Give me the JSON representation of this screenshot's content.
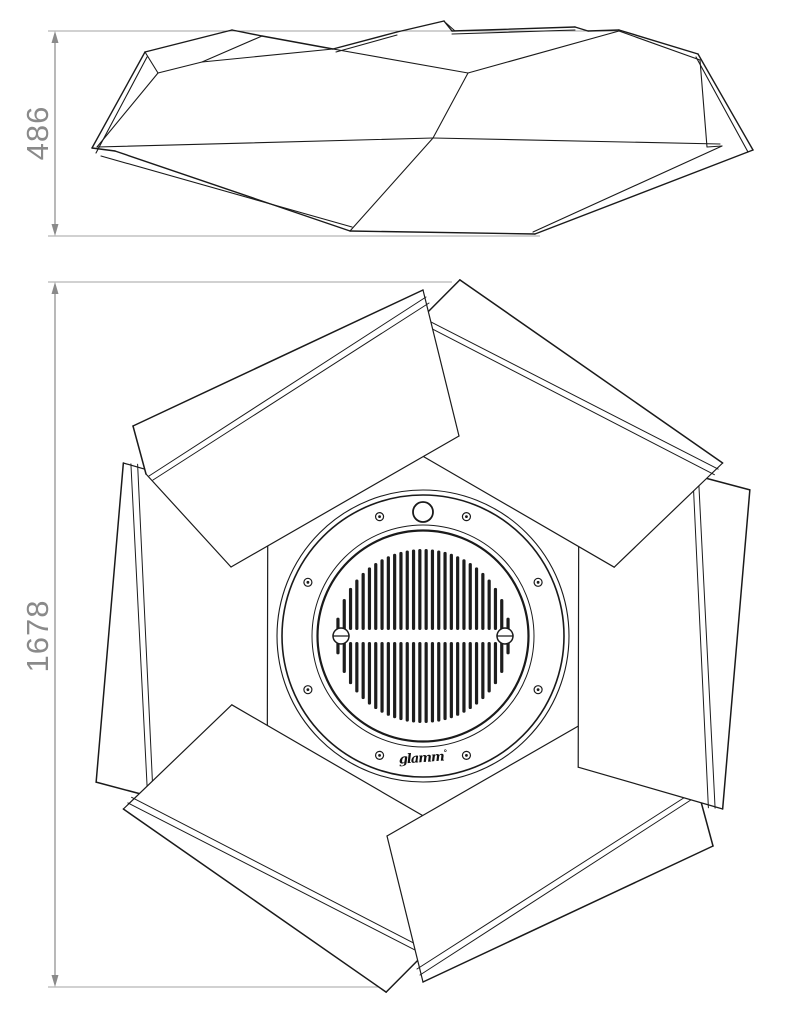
{
  "drawing": {
    "side_view": {
      "dimension_label": "486"
    },
    "plan_view": {
      "dimension_label": "1678",
      "logo_text": "glamm",
      "logo_mark": "°"
    },
    "colors": {
      "background": "#ffffff",
      "line": "#1a1a1a",
      "dimension": "#8a8a8a",
      "extension": "#a3a3a3"
    }
  }
}
